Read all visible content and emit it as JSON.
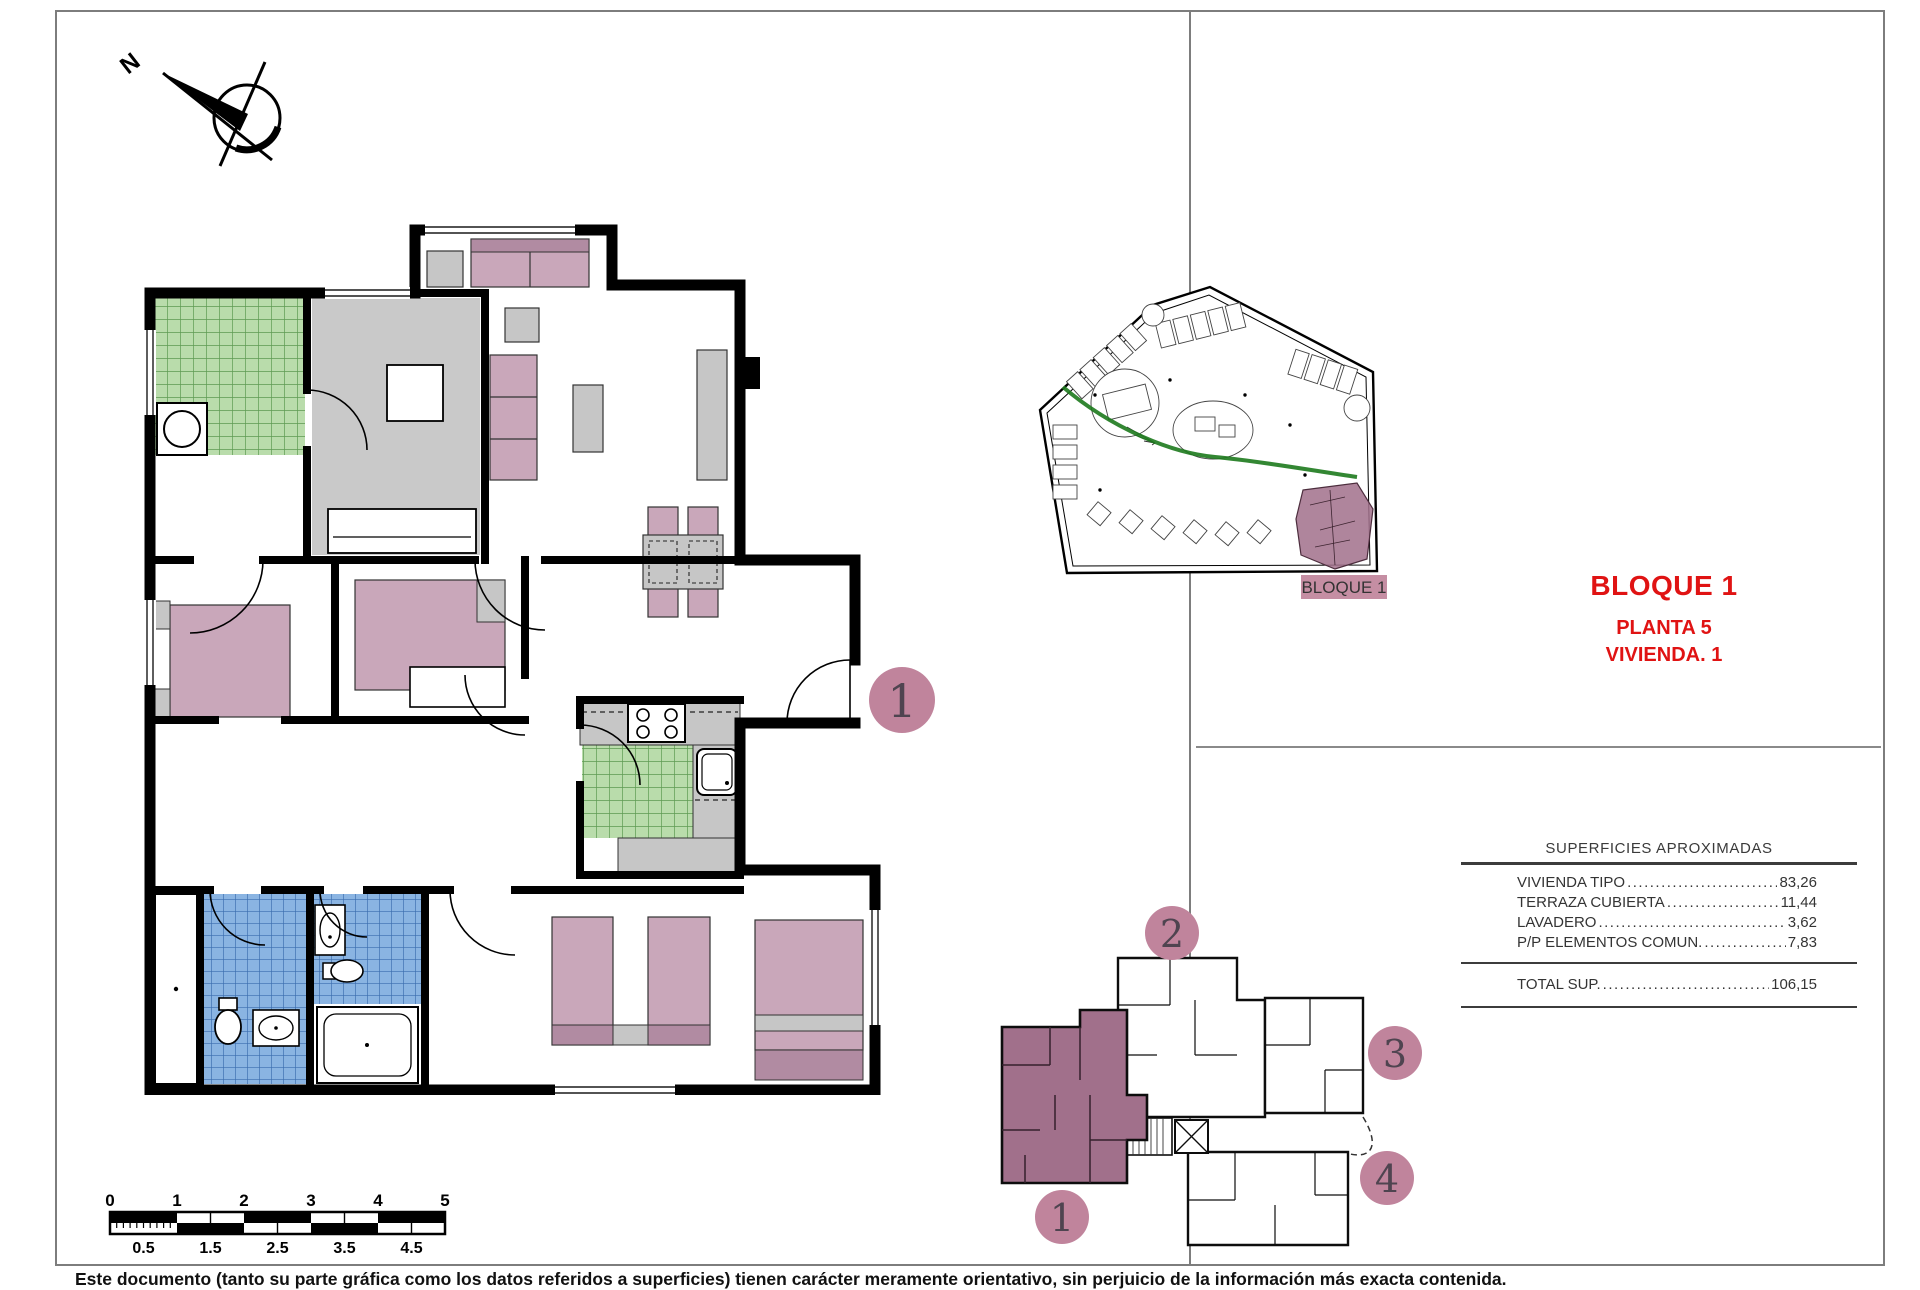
{
  "page": {
    "background": "#ffffff",
    "frame_color": "#7d7d7d"
  },
  "north_arrow": {
    "label": "N"
  },
  "title_block": {
    "line1": "BLOQUE 1",
    "line2": "PLANTA 5",
    "line3": "VIVIENDA. 1",
    "accent_color": "#e01313"
  },
  "surfaces_table": {
    "header": "SUPERFICIES APROXIMADAS",
    "rows": [
      {
        "label": "VIVIENDA TIPO",
        "value": "83,26"
      },
      {
        "label": "TERRAZA CUBIERTA",
        "value": "11,44"
      },
      {
        "label": "LAVADERO",
        "value": "3,62"
      },
      {
        "label": "P/P ELEMENTOS COMUN.",
        "value": "7,83"
      }
    ],
    "total_label": "TOTAL SUP.",
    "total_value": "106,15"
  },
  "site_plan": {
    "block_label": "BLOQUE 1",
    "highlight_color": "#a1708b",
    "label_bg": "#c58ea3",
    "green_path_color": "#1d7a1d"
  },
  "key_plan": {
    "markers": [
      "1",
      "2",
      "3",
      "4"
    ],
    "highlighted_unit": "1",
    "highlight_color": "#a1708b",
    "marker_color": "#c0849c"
  },
  "main_plan": {
    "unit_marker": "1",
    "colors": {
      "wall": "#000000",
      "floor_gray": "#c9c9c9",
      "furniture_gray": "#c6c6c6",
      "furniture_pink": "#c9a7ba",
      "furniture_pink_dark": "#b18ba2",
      "tile_green": "#b9dcab",
      "tile_green_line": "#5d9a52",
      "tile_blue": "#8ab4e2",
      "tile_blue_line": "#3a6cae",
      "marker_fill": "#c0849c"
    }
  },
  "scale_bar": {
    "major_labels": [
      "0",
      "1",
      "2",
      "3",
      "4",
      "5"
    ],
    "minor_labels": [
      "0.5",
      "1.5",
      "2.5",
      "3.5",
      "4.5"
    ]
  },
  "footer": {
    "disclaimer": "Este documento (tanto su parte gráfica como los datos referidos a superficies) tienen carácter meramente orientativo, sin perjuicio de la información más exacta contenida."
  }
}
